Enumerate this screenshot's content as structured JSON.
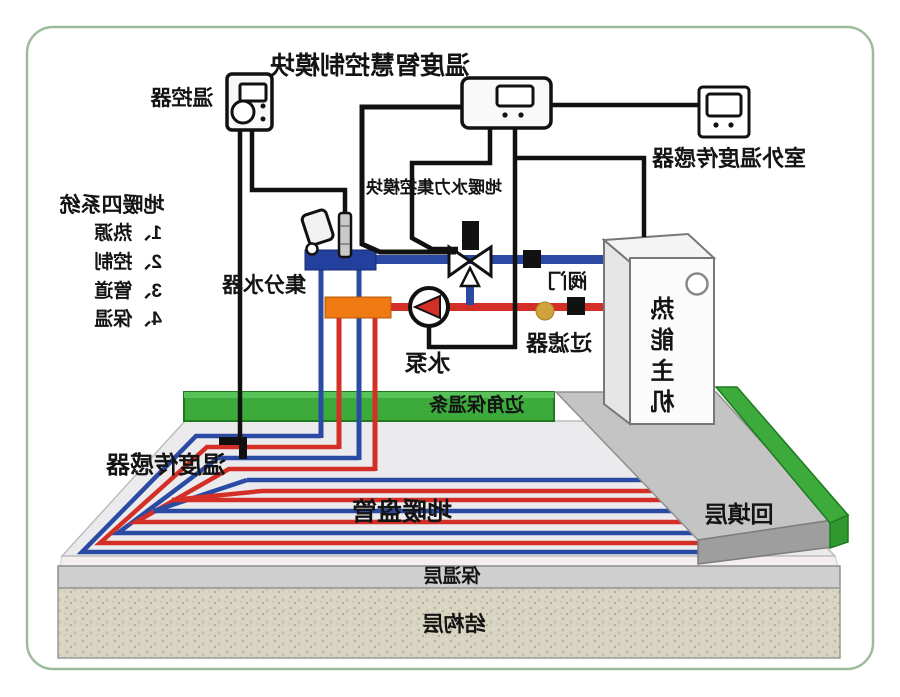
{
  "diagram": {
    "title_module": "温度智慧控制模块",
    "labels": {
      "thermostat": "温控器",
      "outdoor_sensor": "室外温度传感器",
      "hydraulic_module": "地暖水力集控模块",
      "manifold": "集分水器",
      "pump": "水泵",
      "valve": "阀门",
      "filter": "过滤器",
      "heat_unit": "热能主机",
      "edge_insulation": "边角保温条",
      "floor_sensor": "温度传感器",
      "coil": "地暖盘管",
      "backfill_layer": "回填层",
      "insulation_layer": "保温层",
      "structure_layer": "结构层"
    },
    "legend": {
      "title": "地暖四系统",
      "items": [
        "1、热源",
        "2、控制",
        "3、管道",
        "4、保温"
      ]
    },
    "colors": {
      "supply_red": "#d42f26",
      "return_blue": "#2a4aa4",
      "manifold_orange": "#f07a12",
      "manifold_blue": "#24409e",
      "insulation_green": "#3cab3c",
      "filter_gold": "#d0a23c"
    }
  }
}
